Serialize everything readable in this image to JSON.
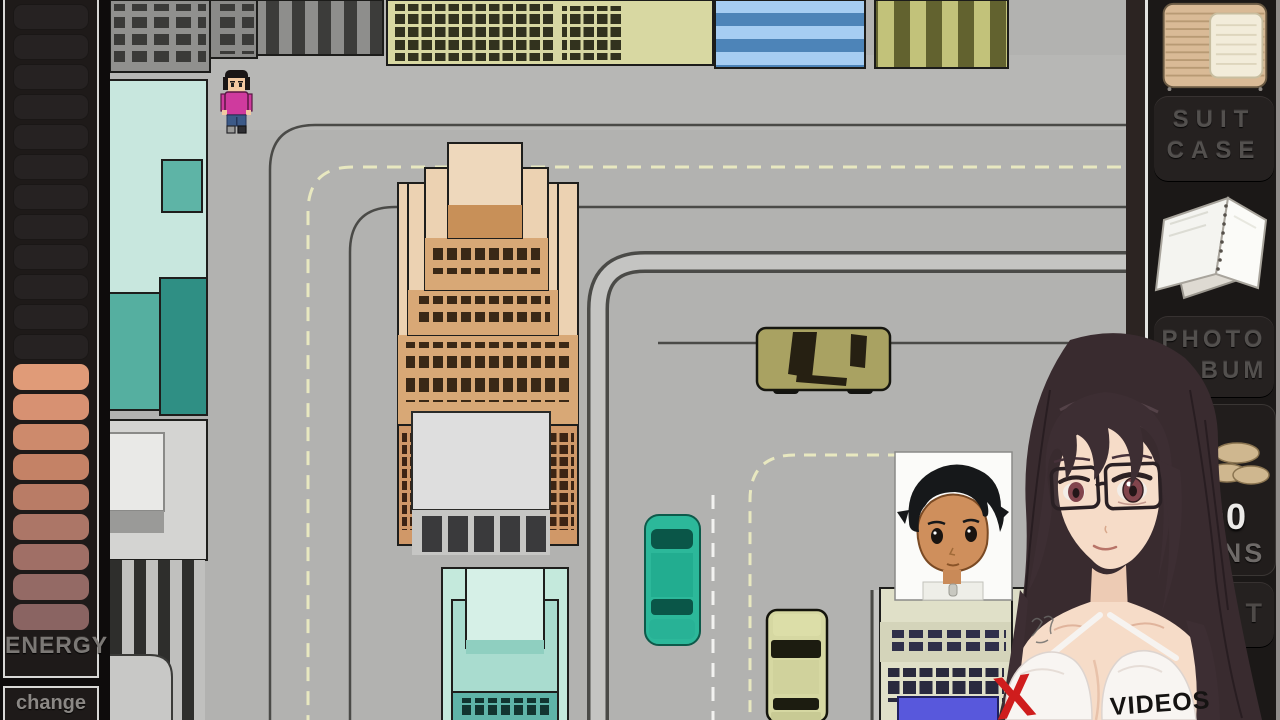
{
  "left_sidebar": {
    "energy_label": "ENERGY",
    "change_label": "change",
    "energy_bar": {
      "empty_segments": 12,
      "filled_segments": 9,
      "empty_color": "#262222",
      "filled_colors_top_to_bottom": [
        "#e09b78",
        "#d79172",
        "#cd8a6c",
        "#c48266",
        "#b97c66",
        "#ac7667",
        "#a06f66",
        "#946a65",
        "#8a6462"
      ]
    }
  },
  "right_sidebar": {
    "suitcase_label_line1": "SUIT",
    "suitcase_label_line2": "CASE",
    "photo_album_label_line1": "PHOTO",
    "photo_album_label_line2": "ALBUM",
    "coins_amount": "490",
    "coins_label": "COINS",
    "partial_button_visible_text": "T"
  },
  "character_overlay": {
    "x_mark": "X",
    "videos_label": "VIDEOS",
    "x_color": "#cf1d1d"
  },
  "palette": {
    "road": "#b2b2b0",
    "curb": "#4a4a47",
    "lane_dash_yellow": "#e8e8c0",
    "lane_dash_white": "#f2f2f0",
    "sidebar_bg": "#1b1817",
    "button_text": "#53504e"
  }
}
